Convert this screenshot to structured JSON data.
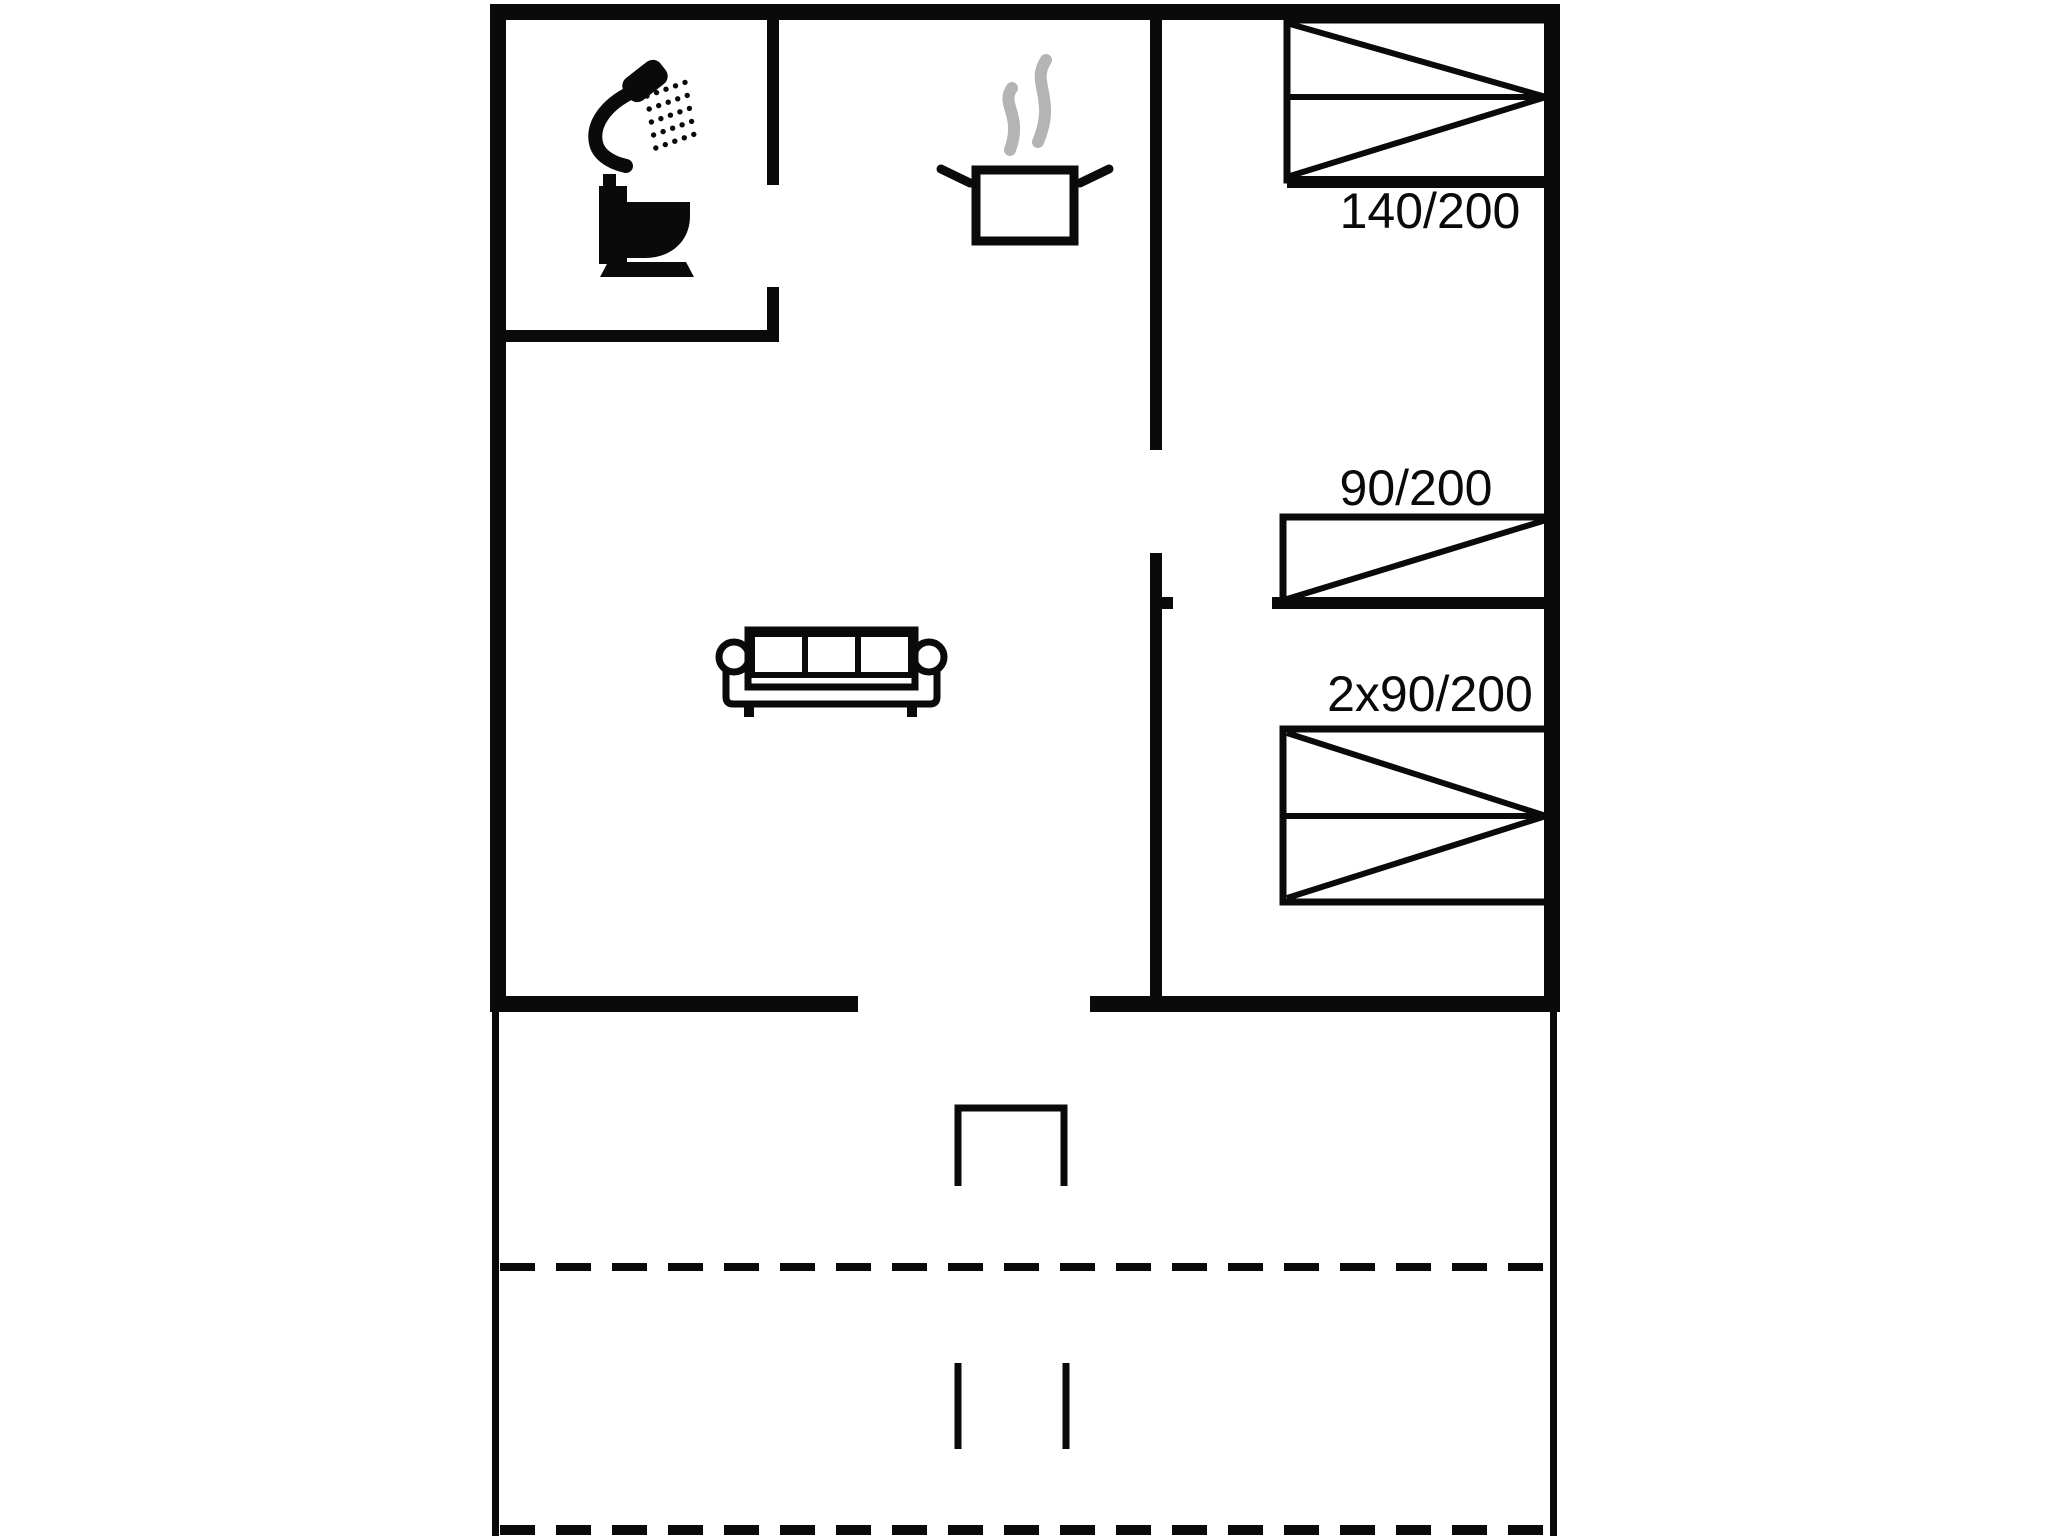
{
  "title": "Holiday home floor plan",
  "colors": {
    "background": "#ffffff",
    "line": "#0a0a0a",
    "steam": "#b4b4b4"
  },
  "bedrooms": {
    "double": {
      "bed_label": "140/200"
    },
    "single": {
      "bed_label": "90/200"
    },
    "twin": {
      "bed_label": "2x90/200"
    }
  },
  "icons": {
    "shower": "shower-icon",
    "toilet": "toilet-icon",
    "cooking_pot": "cooking-pot-icon",
    "steam": "steam-icon",
    "sofa": "sofa-icon",
    "door_step": "terrace-door-step",
    "path_markers": "terrace-path-markers"
  }
}
